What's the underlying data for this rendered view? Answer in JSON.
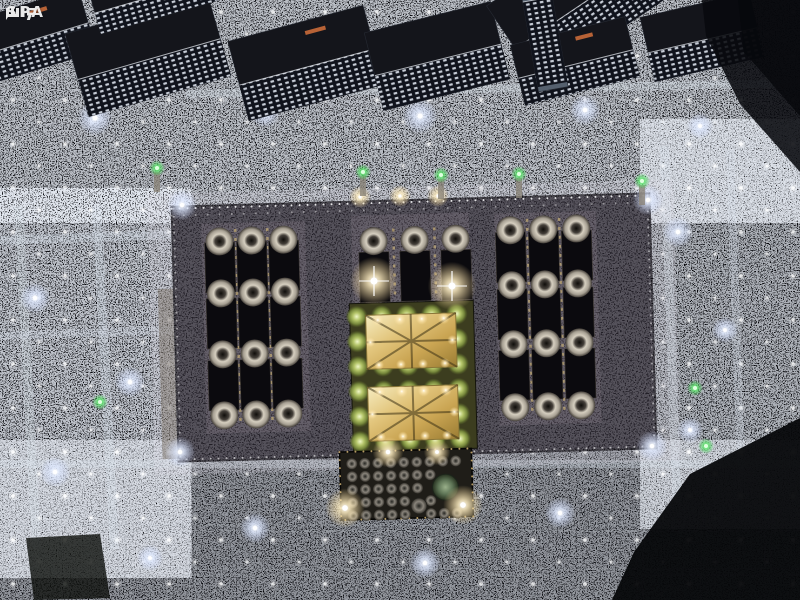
{
  "watermark": {
    "line1": "واس",
    "line2": "SPA"
  },
  "palette": {
    "night_sky": "#05060a",
    "crowd_speck": "#dde6f2",
    "roof_base": "#211e26",
    "wing_base": "#39343d",
    "dark_court": "#0b0a0e",
    "gold": "#e2c57c",
    "green_glow": "#59e06b",
    "courtyard_green": "#3c3d1f",
    "dome_light": "#d6cfc0",
    "warm_light": "#ffeec2",
    "cool_light": "#dfe9ff",
    "building_roof": "#14151b",
    "building_facade_window": "#e8eef8",
    "annex_base": "#1f1d18",
    "green_dome": "#5d7355"
  },
  "scene": {
    "crowd_regions": [
      {
        "x": 0,
        "y": 0,
        "w": 800,
        "h": 212,
        "o": 0.78
      },
      {
        "x": 0,
        "y": 206,
        "w": 182,
        "h": 354,
        "o": 0.8
      },
      {
        "x": 648,
        "y": 138,
        "w": 152,
        "h": 372,
        "o": 0.72
      },
      {
        "x": 0,
        "y": 448,
        "w": 800,
        "h": 152,
        "o": 0.6
      }
    ],
    "pathways": [
      {
        "x": 14,
        "y": 206,
        "w": 9,
        "h": 344,
        "rot": -3,
        "o": 0.28
      },
      {
        "x": 92,
        "y": 206,
        "w": 9,
        "h": 344,
        "rot": -3,
        "o": 0.3
      },
      {
        "x": 0,
        "y": 236,
        "w": 182,
        "h": 9,
        "rot": -2,
        "o": 0.3
      },
      {
        "x": 0,
        "y": 332,
        "w": 182,
        "h": 8,
        "rot": -2,
        "o": 0.25
      },
      {
        "x": 660,
        "y": 146,
        "w": 9,
        "h": 356,
        "rot": -2,
        "o": 0.3
      },
      {
        "x": 726,
        "y": 150,
        "w": 8,
        "h": 340,
        "rot": -2,
        "o": 0.25
      },
      {
        "x": 0,
        "y": 460,
        "w": 800,
        "h": 8,
        "rot": 0,
        "o": 0.3
      },
      {
        "x": 186,
        "y": 90,
        "w": 614,
        "h": 8,
        "rot": -1,
        "o": 0.32
      }
    ],
    "paving": [
      {
        "x": 0,
        "y": 512,
        "w": 800,
        "h": 88,
        "o": 0.4
      },
      {
        "x": 182,
        "y": 452,
        "w": 152,
        "h": 62,
        "o": 0.3
      },
      {
        "x": 470,
        "y": 452,
        "w": 180,
        "h": 62,
        "o": 0.3
      }
    ],
    "dark_under": [
      {
        "points": "612,600 800,600 800,418 690,474 634,552",
        "fill": "#06070a",
        "o": 0.95
      },
      {
        "points": "26,538 100,534 110,598 34,600",
        "fill": "#0e100d",
        "o": 0.8
      }
    ],
    "dark_over": [
      {
        "points": "702,0 800,0 800,172 740,104 706,36",
        "fill": "#08090e",
        "o": 0.88
      },
      {
        "points": "738,0 800,0 800,116 744,52",
        "fill": "#06070b",
        "o": 0.8
      }
    ],
    "mosque": {
      "rot": -1.6,
      "cx": 414,
      "cy": 328,
      "roof": {
        "x": 175,
        "y": 200,
        "w": 478,
        "h": 255
      },
      "west_wall": {
        "x": 159,
        "y": 282,
        "w": 15,
        "h": 170
      },
      "wing_bgs": [
        {
          "x": 204,
          "y": 218,
          "w": 104,
          "h": 210
        },
        {
          "x": 497,
          "y": 216,
          "w": 102,
          "h": 212
        },
        {
          "x": 354,
          "y": 214,
          "w": 118,
          "h": 92
        }
      ],
      "wings": [
        {
          "cols": [
            222,
            254,
            286
          ],
          "domeRows": [
            236,
            288,
            349,
            410
          ],
          "rectRows": [
            262,
            318,
            380
          ]
        },
        {
          "cols": [
            513,
            546,
            579
          ],
          "domeRows": [
            233,
            288,
            347,
            410
          ],
          "rectRows": [
            260,
            317,
            378
          ]
        },
        {
          "cols": [
            376,
            417,
            458
          ],
          "domeRows": [
            240
          ],
          "rectRows": [
            276
          ]
        }
      ],
      "domeR": 14,
      "rectW": 30,
      "rectH": 50,
      "gold_strips": [
        {
          "x": 238,
          "y1": 224,
          "y2": 420
        },
        {
          "x": 270,
          "y1": 224,
          "y2": 420
        },
        {
          "x": 530,
          "y1": 222,
          "y2": 420
        },
        {
          "x": 562,
          "y1": 222,
          "y2": 420
        },
        {
          "x": 396,
          "y1": 228,
          "y2": 300
        },
        {
          "x": 437,
          "y1": 228,
          "y2": 300
        }
      ],
      "courtyard": {
        "x": 350,
        "y": 302,
        "w": 124,
        "h": 148,
        "cols": [
          357,
          382,
          407,
          432,
          457
        ],
        "rows": [
          315,
          340,
          365,
          390,
          415,
          440
        ],
        "r": 11,
        "clusters": [
          {
            "x": 366,
            "y": 314,
            "w": 90,
            "h": 54
          },
          {
            "x": 366,
            "y": 386,
            "w": 90,
            "h": 54
          }
        ]
      },
      "annex": {
        "x": 336,
        "y": 450,
        "w": 132,
        "h": 68,
        "grid": {
          "x0": 348,
          "y0": 462,
          "dx": 13,
          "dy": 13,
          "cols": 9,
          "rows": 5,
          "r": 5.5
        },
        "big_dome": {
          "x": 441,
          "y": 488,
          "r": 13
        },
        "small_dome": {
          "x": 414,
          "y": 506,
          "r": 8
        }
      }
    },
    "glows": [
      {
        "x": 374,
        "y": 281,
        "r": 11,
        "k": "w",
        "flare": true
      },
      {
        "x": 452,
        "y": 286,
        "r": 11,
        "k": "w",
        "flare": true
      },
      {
        "x": 345,
        "y": 508,
        "r": 9,
        "k": "w"
      },
      {
        "x": 463,
        "y": 505,
        "r": 9,
        "k": "w"
      },
      {
        "x": 388,
        "y": 452,
        "r": 7,
        "k": "w"
      },
      {
        "x": 437,
        "y": 452,
        "r": 6,
        "k": "w"
      },
      {
        "x": 360,
        "y": 197,
        "r": 5,
        "k": "w"
      },
      {
        "x": 400,
        "y": 196,
        "r": 5,
        "k": "w"
      },
      {
        "x": 438,
        "y": 196,
        "r": 5,
        "k": "w"
      },
      {
        "x": 182,
        "y": 205,
        "r": 7,
        "k": "c"
      },
      {
        "x": 648,
        "y": 200,
        "r": 7,
        "k": "c"
      },
      {
        "x": 180,
        "y": 452,
        "r": 7,
        "k": "c"
      },
      {
        "x": 652,
        "y": 446,
        "r": 7,
        "k": "c"
      },
      {
        "x": 95,
        "y": 118,
        "r": 8,
        "k": "c"
      },
      {
        "x": 265,
        "y": 112,
        "r": 7,
        "k": "c"
      },
      {
        "x": 420,
        "y": 116,
        "r": 8,
        "k": "c"
      },
      {
        "x": 585,
        "y": 110,
        "r": 7,
        "k": "c"
      },
      {
        "x": 700,
        "y": 126,
        "r": 6,
        "k": "c"
      },
      {
        "x": 35,
        "y": 298,
        "r": 7,
        "k": "c"
      },
      {
        "x": 130,
        "y": 382,
        "r": 7,
        "k": "c"
      },
      {
        "x": 55,
        "y": 472,
        "r": 7,
        "k": "c"
      },
      {
        "x": 678,
        "y": 232,
        "r": 7,
        "k": "c"
      },
      {
        "x": 725,
        "y": 330,
        "r": 6,
        "k": "c"
      },
      {
        "x": 690,
        "y": 430,
        "r": 6,
        "k": "c"
      },
      {
        "x": 255,
        "y": 528,
        "r": 7,
        "k": "c"
      },
      {
        "x": 425,
        "y": 563,
        "r": 7,
        "k": "c"
      },
      {
        "x": 560,
        "y": 513,
        "r": 7,
        "k": "c"
      },
      {
        "x": 150,
        "y": 558,
        "r": 6,
        "k": "c"
      }
    ],
    "minaret_lights": [
      {
        "x": 157,
        "y": 168,
        "body": true
      },
      {
        "x": 363,
        "y": 172,
        "body": true
      },
      {
        "x": 441,
        "y": 175,
        "body": true
      },
      {
        "x": 519,
        "y": 174,
        "body": true
      },
      {
        "x": 642,
        "y": 181,
        "body": true
      },
      {
        "x": 100,
        "y": 402
      },
      {
        "x": 695,
        "y": 388
      },
      {
        "x": 706,
        "y": 446
      }
    ],
    "buildings": [
      {
        "x": -28,
        "y": 4,
        "w": 118,
        "h": 66,
        "rot": -17,
        "accent": true
      },
      {
        "x": 74,
        "y": 12,
        "w": 148,
        "h": 86,
        "rot": -16
      },
      {
        "x": 236,
        "y": 22,
        "w": 140,
        "h": 82,
        "rot": -15,
        "accent": true
      },
      {
        "x": 372,
        "y": 16,
        "w": 130,
        "h": 80,
        "rot": -14
      },
      {
        "x": 500,
        "y": -44,
        "w": 150,
        "h": 94,
        "rot": -34
      },
      {
        "x": 516,
        "y": 30,
        "w": 118,
        "h": 62,
        "rot": -14,
        "accent": true
      },
      {
        "x": 646,
        "y": 4,
        "w": 112,
        "h": 66,
        "rot": -13
      },
      {
        "x": 92,
        "y": -30,
        "w": 122,
        "h": 48,
        "rot": -16
      },
      {
        "x": 530,
        "y": -6,
        "w": 30,
        "h": 96,
        "rot": -10,
        "bright": true
      }
    ]
  }
}
